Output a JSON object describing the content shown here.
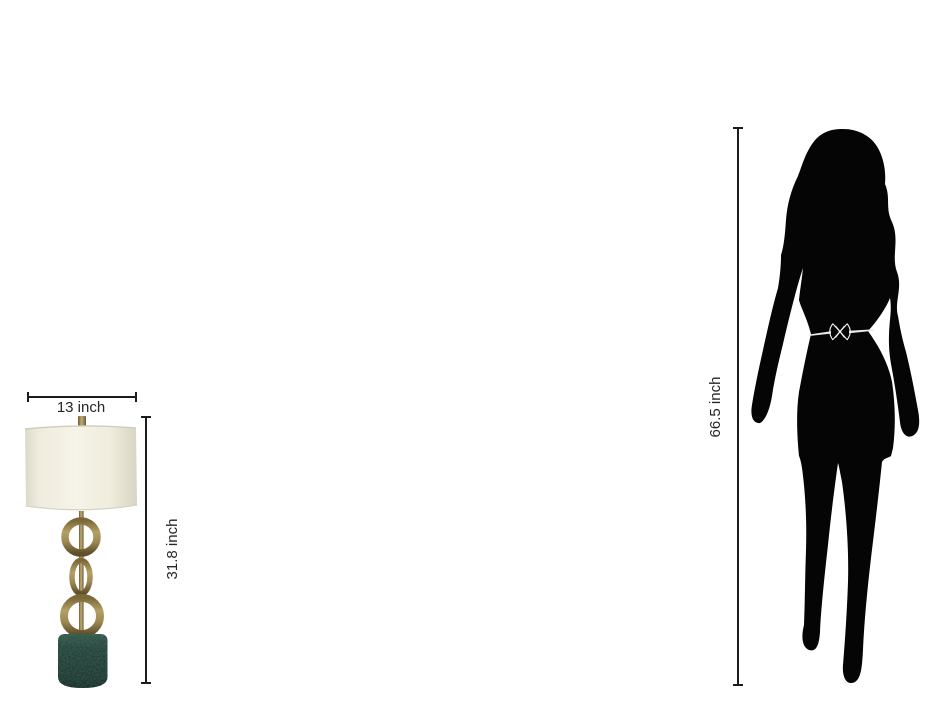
{
  "page": {
    "title": "product size comparison",
    "background": "#ffffff"
  },
  "lamp": {
    "name": "table lamp with brass rings and green marble base",
    "width_dimension_label": "13 inch",
    "height_dimension_label": "31.8 inch",
    "colors": {
      "shade": "#f2efe2",
      "brass": "#9a8750",
      "marble_green": "#1c3831"
    }
  },
  "person": {
    "name": "female walking silhouette",
    "height_dimension_label": "66.5 inch",
    "color": "#050505",
    "belt_color": "#efefef"
  },
  "dimension_style": {
    "line_color": "#1c1c1c",
    "text_color": "#262626"
  }
}
